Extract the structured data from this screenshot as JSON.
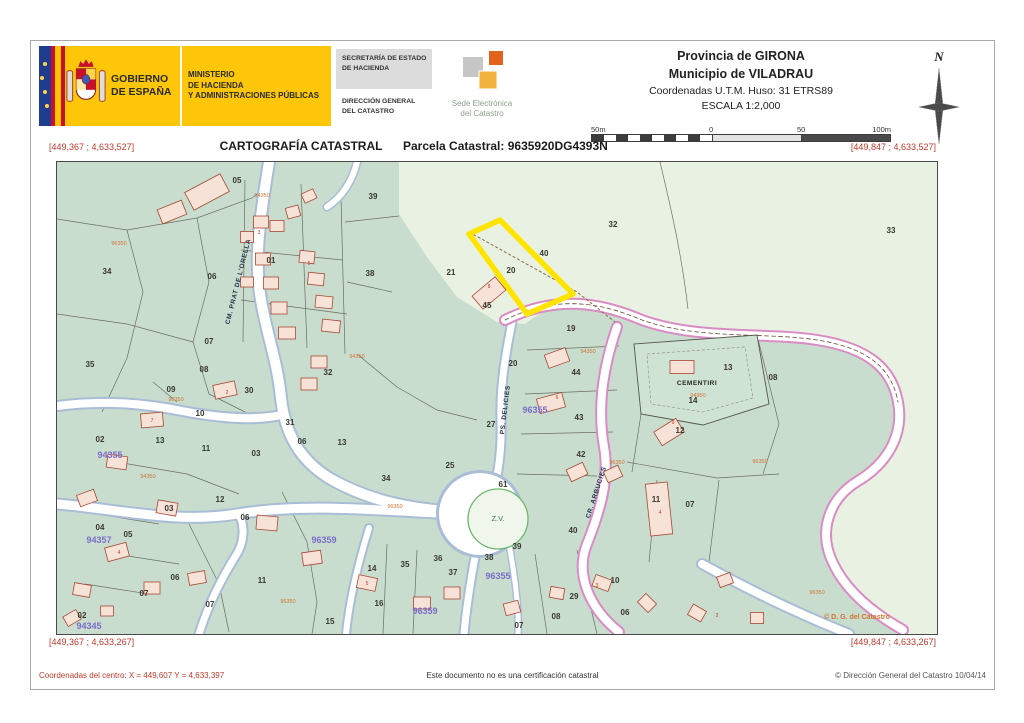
{
  "header": {
    "gobierno": "GOBIERNO\nDE ESPAÑA",
    "ministerio": "MINISTERIO\nDE HACIENDA\nY ADMINISTRACIONES PÚBLICAS",
    "secretaria": "SECRETARÍA DE ESTADO\nDE HACIENDA",
    "direccion": "DIRECCIÓN GENERAL\nDEL CATASTRO",
    "sede": "Sede Electrónica\ndel Catastro",
    "provincia": "Provincia de GIRONA",
    "municipio": "Municipio de VILADRAU",
    "coordenadas": "Coordenadas U.T.M. Huso: 31 ETRS89",
    "escala": "ESCALA 1:2,000",
    "compass_n": "N",
    "scale_labels": [
      "50m",
      "0",
      "50",
      "100m"
    ]
  },
  "title_bar": {
    "left_coord": "[449,367 ; 4,633,527]",
    "title": "CARTOGRAFÍA CATASTRAL",
    "parcel": "Parcela Catastral: 9635920DG4393N",
    "right_coord": "[449,847 ; 4,633,527]"
  },
  "bottom_bar": {
    "left_coord": "[449,367 ; 4,633,267]",
    "right_coord": "[449,847 ; 4,633,267]"
  },
  "footer": {
    "center_coords": "Coordenadas del centro: X = 449,607 Y = 4,633,397",
    "disclaimer": "Este documento no es una certificación catastral",
    "copyright": "© Dirección General del Catastro 10/04/14"
  },
  "map": {
    "colors": {
      "rustic_pale_green": "#e9f2e2",
      "urban_teal": "#c9ddcf",
      "road_casing_blue": "#a9bdd6",
      "road_casing_pink": "#d98cc4",
      "highlight_yellow": "#ffe400",
      "building_fill": "#f7e2d7",
      "building_stroke": "#a84832",
      "coord_red": "#c0392b",
      "zone_purple": "#7b6ec9",
      "code_orange": "#d07232"
    },
    "labels": [
      {
        "x": 180,
        "y": 21,
        "t": "05",
        "c": "pnum"
      },
      {
        "x": 50,
        "y": 112,
        "t": "34",
        "c": "pnum"
      },
      {
        "x": 33,
        "y": 205,
        "t": "35",
        "c": "pnum"
      },
      {
        "x": 155,
        "y": 117,
        "t": "06",
        "c": "pnum"
      },
      {
        "x": 152,
        "y": 182,
        "t": "07",
        "c": "pnum"
      },
      {
        "x": 147,
        "y": 210,
        "t": "08",
        "c": "pnum"
      },
      {
        "x": 114,
        "y": 230,
        "t": "09",
        "c": "pnum"
      },
      {
        "x": 214,
        "y": 101,
        "t": "01",
        "c": "pnum"
      },
      {
        "x": 192,
        "y": 231,
        "t": "30",
        "c": "pnum"
      },
      {
        "x": 271,
        "y": 213,
        "t": "32",
        "c": "pnum"
      },
      {
        "x": 316,
        "y": 37,
        "t": "39",
        "c": "pnum"
      },
      {
        "x": 313,
        "y": 114,
        "t": "38",
        "c": "pnum"
      },
      {
        "x": 556,
        "y": 65,
        "t": "32",
        "c": "pnum"
      },
      {
        "x": 834,
        "y": 71,
        "t": "33",
        "c": "pnum"
      },
      {
        "x": 454,
        "y": 111,
        "t": "20",
        "c": "pnum"
      },
      {
        "x": 487,
        "y": 94,
        "t": "40",
        "c": "pnum"
      },
      {
        "x": 430,
        "y": 146,
        "t": "45",
        "c": "pnum"
      },
      {
        "x": 514,
        "y": 169,
        "t": "19",
        "c": "pnum"
      },
      {
        "x": 394,
        "y": 113,
        "t": "21",
        "c": "pnum"
      },
      {
        "x": 456,
        "y": 204,
        "t": "20",
        "c": "pnum"
      },
      {
        "x": 519,
        "y": 213,
        "t": "44",
        "c": "pnum"
      },
      {
        "x": 522,
        "y": 258,
        "t": "43",
        "c": "pnum"
      },
      {
        "x": 524,
        "y": 295,
        "t": "42",
        "c": "pnum"
      },
      {
        "x": 636,
        "y": 241,
        "t": "14",
        "c": "pnum"
      },
      {
        "x": 623,
        "y": 271,
        "t": "12",
        "c": "pnum"
      },
      {
        "x": 599,
        "y": 340,
        "t": "11",
        "c": "pnum"
      },
      {
        "x": 633,
        "y": 345,
        "t": "07",
        "c": "pnum"
      },
      {
        "x": 434,
        "y": 265,
        "t": "27",
        "c": "pnum"
      },
      {
        "x": 671,
        "y": 208,
        "t": "13",
        "c": "pnum"
      },
      {
        "x": 716,
        "y": 218,
        "t": "08",
        "c": "pnum"
      },
      {
        "x": 393,
        "y": 306,
        "t": "25",
        "c": "pnum"
      },
      {
        "x": 329,
        "y": 319,
        "t": "34",
        "c": "pnum"
      },
      {
        "x": 446,
        "y": 325,
        "t": "61",
        "c": "pnum"
      },
      {
        "x": 516,
        "y": 371,
        "t": "40",
        "c": "pnum"
      },
      {
        "x": 348,
        "y": 405,
        "t": "35",
        "c": "pnum"
      },
      {
        "x": 381,
        "y": 399,
        "t": "36",
        "c": "pnum"
      },
      {
        "x": 396,
        "y": 413,
        "t": "37",
        "c": "pnum"
      },
      {
        "x": 432,
        "y": 398,
        "t": "38",
        "c": "pnum"
      },
      {
        "x": 460,
        "y": 387,
        "t": "39",
        "c": "pnum"
      },
      {
        "x": 558,
        "y": 421,
        "t": "10",
        "c": "pnum"
      },
      {
        "x": 517,
        "y": 437,
        "t": "29",
        "c": "pnum"
      },
      {
        "x": 499,
        "y": 457,
        "t": "08",
        "c": "pnum"
      },
      {
        "x": 462,
        "y": 466,
        "t": "07",
        "c": "pnum"
      },
      {
        "x": 568,
        "y": 453,
        "t": "06",
        "c": "pnum"
      },
      {
        "x": 43,
        "y": 280,
        "t": "02",
        "c": "pnum"
      },
      {
        "x": 103,
        "y": 281,
        "t": "13",
        "c": "pnum"
      },
      {
        "x": 143,
        "y": 254,
        "t": "10",
        "c": "pnum"
      },
      {
        "x": 149,
        "y": 289,
        "t": "11",
        "c": "pnum"
      },
      {
        "x": 199,
        "y": 294,
        "t": "03",
        "c": "pnum"
      },
      {
        "x": 233,
        "y": 263,
        "t": "31",
        "c": "pnum"
      },
      {
        "x": 245,
        "y": 282,
        "t": "06",
        "c": "pnum"
      },
      {
        "x": 285,
        "y": 283,
        "t": "13",
        "c": "pnum"
      },
      {
        "x": 163,
        "y": 340,
        "t": "12",
        "c": "pnum"
      },
      {
        "x": 112,
        "y": 349,
        "t": "03",
        "c": "pnum"
      },
      {
        "x": 43,
        "y": 368,
        "t": "04",
        "c": "pnum"
      },
      {
        "x": 71,
        "y": 375,
        "t": "05",
        "c": "pnum"
      },
      {
        "x": 188,
        "y": 358,
        "t": "06",
        "c": "pnum"
      },
      {
        "x": 118,
        "y": 418,
        "t": "06",
        "c": "pnum"
      },
      {
        "x": 87,
        "y": 434,
        "t": "07",
        "c": "pnum"
      },
      {
        "x": 205,
        "y": 421,
        "t": "11",
        "c": "pnum"
      },
      {
        "x": 315,
        "y": 409,
        "t": "14",
        "c": "pnum"
      },
      {
        "x": 25,
        "y": 456,
        "t": "02",
        "c": "pnum"
      },
      {
        "x": 273,
        "y": 462,
        "t": "15",
        "c": "pnum"
      },
      {
        "x": 322,
        "y": 444,
        "t": "16",
        "c": "pnum"
      },
      {
        "x": 153,
        "y": 445,
        "t": "07",
        "c": "pnum"
      },
      {
        "x": 53,
        "y": 296,
        "t": "94355",
        "c": "zone"
      },
      {
        "x": 42,
        "y": 381,
        "t": "94357",
        "c": "zone"
      },
      {
        "x": 267,
        "y": 381,
        "t": "96359",
        "c": "zone"
      },
      {
        "x": 368,
        "y": 452,
        "t": "96359",
        "c": "zone"
      },
      {
        "x": 441,
        "y": 417,
        "t": "96355",
        "c": "zone"
      },
      {
        "x": 478,
        "y": 251,
        "t": "96355",
        "c": "zone"
      },
      {
        "x": 32,
        "y": 467,
        "t": "94345",
        "c": "zone"
      },
      {
        "x": 183,
        "y": 120,
        "t": "CM. PRAT DE L'ORELLA",
        "c": "street",
        "r": -76
      },
      {
        "x": 450,
        "y": 248,
        "t": "PS. DELICIES",
        "c": "street",
        "r": -83
      },
      {
        "x": 541,
        "y": 331,
        "t": "CR. ARBUCIES",
        "c": "street",
        "r": -72
      },
      {
        "x": 640,
        "y": 223,
        "t": "CEMENTIRI",
        "c": "cem"
      },
      {
        "x": 441,
        "y": 359,
        "t": "Z.V.",
        "c": "zv"
      },
      {
        "x": 800,
        "y": 457,
        "t": "© D. G. del Catastro",
        "c": "mapcopy"
      },
      {
        "x": 62,
        "y": 83,
        "t": "96350",
        "c": "ocode"
      },
      {
        "x": 119,
        "y": 239,
        "t": "96350",
        "c": "ocode"
      },
      {
        "x": 300,
        "y": 196,
        "t": "94350",
        "c": "ocode"
      },
      {
        "x": 338,
        "y": 346,
        "t": "96350",
        "c": "ocode"
      },
      {
        "x": 91,
        "y": 316,
        "t": "94350",
        "c": "ocode"
      },
      {
        "x": 231,
        "y": 441,
        "t": "96350",
        "c": "ocode"
      },
      {
        "x": 531,
        "y": 191,
        "t": "94350",
        "c": "ocode"
      },
      {
        "x": 641,
        "y": 235,
        "t": "94950",
        "c": "ocode"
      },
      {
        "x": 703,
        "y": 301,
        "t": "96350",
        "c": "ocode"
      },
      {
        "x": 760,
        "y": 432,
        "t": "96350",
        "c": "ocode"
      },
      {
        "x": 205,
        "y": 35,
        "t": "94350",
        "c": "ocode"
      },
      {
        "x": 560,
        "y": 302,
        "t": "96350",
        "c": "ocode"
      },
      {
        "x": 432,
        "y": 126,
        "t": "8",
        "c": "hnum"
      },
      {
        "x": 202,
        "y": 72,
        "t": "3",
        "c": "hnum"
      },
      {
        "x": 252,
        "y": 103,
        "t": "5",
        "c": "hnum"
      },
      {
        "x": 616,
        "y": 262,
        "t": "9",
        "c": "hnum"
      },
      {
        "x": 603,
        "y": 352,
        "t": "4",
        "c": "hnum"
      },
      {
        "x": 500,
        "y": 237,
        "t": "6",
        "c": "hnum"
      },
      {
        "x": 170,
        "y": 232,
        "t": "2",
        "c": "hnum"
      },
      {
        "x": 95,
        "y": 260,
        "t": "7",
        "c": "hnum"
      },
      {
        "x": 540,
        "y": 425,
        "t": "3",
        "c": "hnum"
      },
      {
        "x": 310,
        "y": 423,
        "t": "5",
        "c": "hnum"
      },
      {
        "x": 62,
        "y": 392,
        "t": "4",
        "c": "hnum"
      },
      {
        "x": 660,
        "y": 455,
        "t": "2",
        "c": "hnum"
      }
    ],
    "buildings": [
      [
        150,
        30,
        40,
        20,
        -28
      ],
      [
        115,
        50,
        26,
        15,
        -22
      ],
      [
        204,
        60,
        15,
        12,
        0
      ],
      [
        220,
        64,
        14,
        11,
        0
      ],
      [
        236,
        50,
        13,
        11,
        -15
      ],
      [
        252,
        34,
        13,
        10,
        -25
      ],
      [
        250,
        95,
        15,
        12,
        6
      ],
      [
        259,
        117,
        16,
        12,
        6
      ],
      [
        267,
        140,
        17,
        12,
        6
      ],
      [
        274,
        164,
        18,
        12,
        6
      ],
      [
        206,
        97,
        15,
        12,
        0
      ],
      [
        214,
        121,
        15,
        12,
        0
      ],
      [
        222,
        146,
        16,
        12,
        0
      ],
      [
        230,
        171,
        17,
        12,
        0
      ],
      [
        190,
        75,
        13,
        11,
        0
      ],
      [
        190,
        120,
        13,
        10,
        0
      ],
      [
        262,
        200,
        16,
        12,
        0
      ],
      [
        252,
        222,
        16,
        12,
        0
      ],
      [
        168,
        228,
        22,
        14,
        -12
      ],
      [
        432,
        131,
        30,
        17,
        -40
      ],
      [
        500,
        196,
        22,
        14,
        -20
      ],
      [
        494,
        241,
        26,
        15,
        -15
      ],
      [
        520,
        310,
        18,
        13,
        -25
      ],
      [
        556,
        312,
        16,
        12,
        -25
      ],
      [
        612,
        270,
        26,
        16,
        -32
      ],
      [
        602,
        347,
        22,
        52,
        -6
      ],
      [
        625,
        205,
        24,
        13,
        0
      ],
      [
        95,
        258,
        22,
        14,
        -5
      ],
      [
        60,
        300,
        20,
        13,
        8
      ],
      [
        30,
        336,
        18,
        12,
        -20
      ],
      [
        110,
        346,
        20,
        13,
        10
      ],
      [
        60,
        390,
        22,
        14,
        -15
      ],
      [
        25,
        428,
        17,
        12,
        10
      ],
      [
        95,
        426,
        16,
        12,
        0
      ],
      [
        140,
        416,
        17,
        12,
        -10
      ],
      [
        210,
        361,
        21,
        14,
        5
      ],
      [
        255,
        396,
        19,
        13,
        -8
      ],
      [
        310,
        421,
        19,
        13,
        12
      ],
      [
        365,
        441,
        17,
        12,
        0
      ],
      [
        395,
        431,
        16,
        12,
        0
      ],
      [
        455,
        446,
        15,
        12,
        -15
      ],
      [
        500,
        431,
        14,
        11,
        10
      ],
      [
        545,
        421,
        17,
        12,
        20
      ],
      [
        590,
        441,
        15,
        12,
        45
      ],
      [
        640,
        451,
        15,
        12,
        30
      ],
      [
        700,
        456,
        13,
        11,
        0
      ],
      [
        668,
        418,
        14,
        11,
        -20
      ],
      [
        15,
        456,
        15,
        11,
        -30
      ],
      [
        50,
        449,
        13,
        10,
        0
      ]
    ]
  }
}
